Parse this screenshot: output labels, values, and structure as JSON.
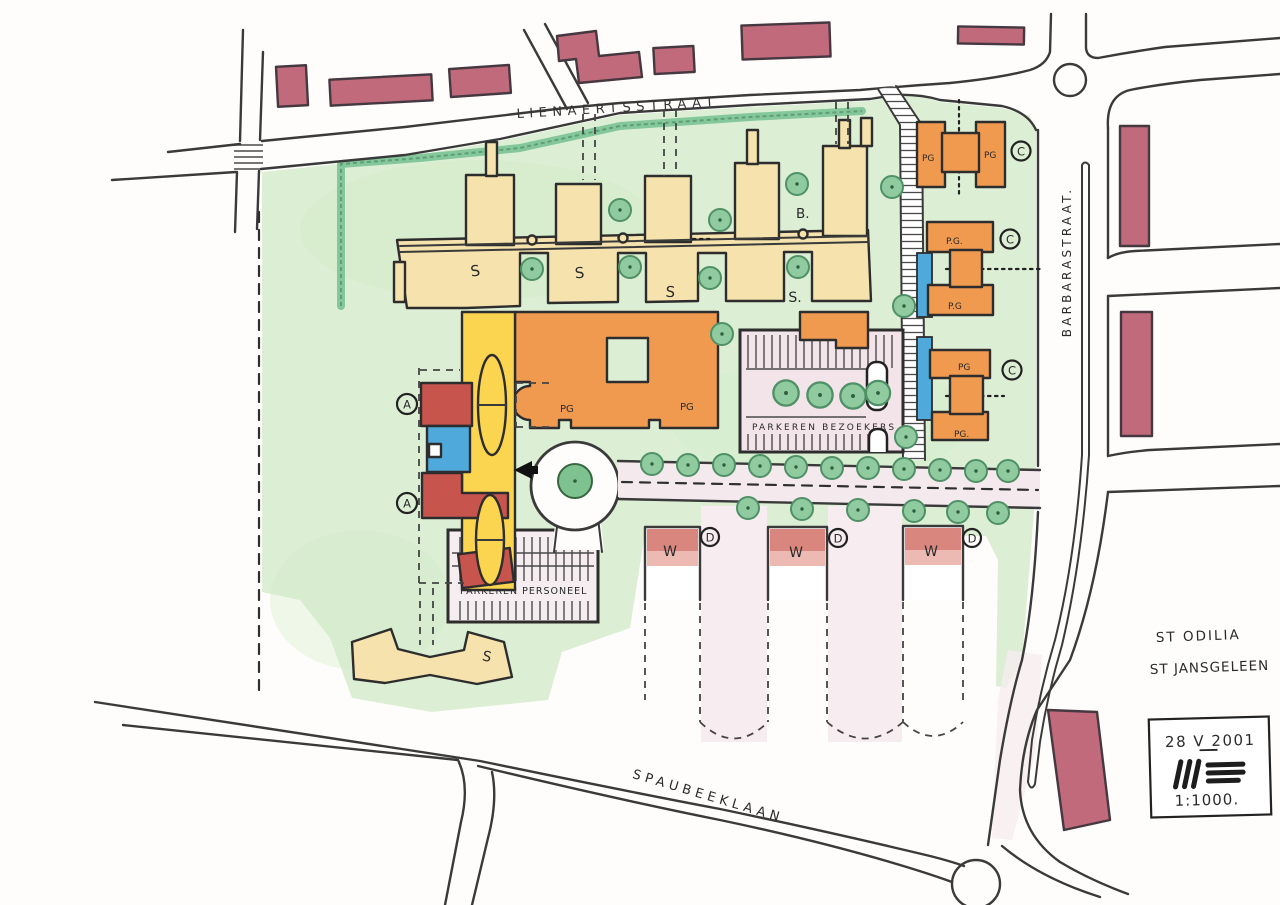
{
  "streets": {
    "lienaertsstraat": "LIENAERTSSTRAAT",
    "barbarastraat": "BARBARASTRAAT.",
    "spaubeeklaan": "SPAUBEEKLAAN"
  },
  "districts": {
    "st_odilia": "ST ODILIA",
    "st_jansgeleen": "ST JANSGELEEN"
  },
  "stamp": {
    "date": "28 V 2001",
    "scale": "1:1000.",
    "monogram_icon": "three-vertical-three-horizontal-bars"
  },
  "parking": {
    "visitors": "PARKEREN BEZOEKERS.",
    "staff": "PARKEREN PERSONEEL"
  },
  "buildings": {
    "s_wings": [
      "S",
      "S",
      "S",
      "S.",
      "S"
    ],
    "b_block": "B.",
    "pg_main": [
      "PG",
      "PG"
    ],
    "pg_house_1": [
      "PG",
      "PG"
    ],
    "pg_house_2": [
      "P.G.",
      "P.G"
    ],
    "pg_house_3": [
      "PG",
      "PG."
    ],
    "w_units": [
      "W",
      "W",
      "W"
    ]
  },
  "zones": {
    "a": [
      "A",
      "A"
    ],
    "c": [
      "C",
      "C",
      "C"
    ],
    "d": [
      "D",
      "D",
      "D"
    ]
  },
  "palette": {
    "site_green": "#DCEFD4",
    "hedge_green": "#84C79A",
    "tree_green": "#8FCB9F",
    "building_cream": "#F5E2AC",
    "building_yellow": "#FBD54F",
    "building_orange": "#F09A50",
    "building_red": "#C8544E",
    "building_blue": "#4FA9DB",
    "existing_maroon": "#C06A7C",
    "parking_pink": "#F2E4E9",
    "ink": "#333333"
  }
}
